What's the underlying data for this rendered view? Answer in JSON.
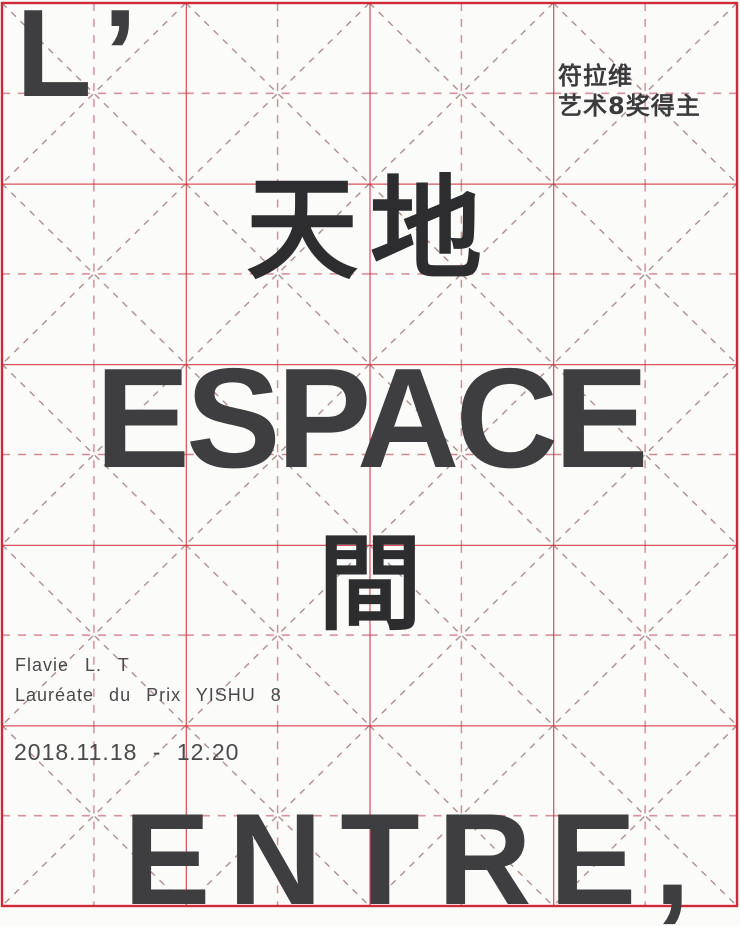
{
  "poster": {
    "top_left_letter": "L’",
    "award_note": {
      "line1": "符拉维",
      "line2": "艺术8奖得主"
    },
    "title_chinese_top": "天地",
    "title_french_main": "ESPACE",
    "title_chinese_middle": "間",
    "artist_name": "Flavie L. T",
    "artist_subtitle": "Lauréate du Prix YISHU 8",
    "exhibition_dates": "2018.11.18 - 12.20",
    "title_french_bottom": "ENTRE,"
  },
  "colors": {
    "grid_solid_red": "#d02a38",
    "grid_dash_pink": "#d4868e",
    "grid_dash_gray": "#a98585",
    "latin_text_dark": "#3e3e40",
    "calligraphy_ink": "#2d2d2f",
    "small_text_gray": "#4a4a4c",
    "paper_background": "#fbfbfa"
  },
  "grid": {
    "columns": 4,
    "rows": 5,
    "style": "mi-zi-ge calligraphy practice grid (solid cell borders, dashed diagonals and dashed center cross per cell)"
  }
}
